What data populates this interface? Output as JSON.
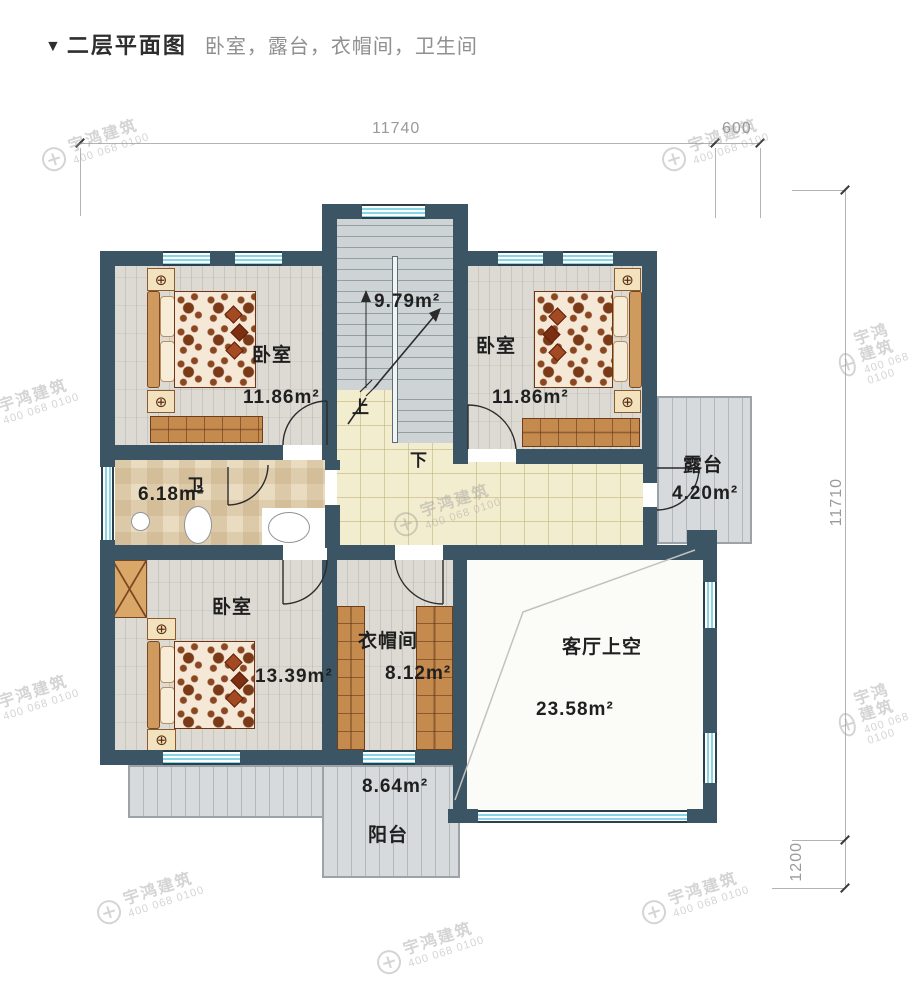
{
  "header": {
    "marker": "▼",
    "title": "二层平面图",
    "subtitle": "卧室，露台，衣帽间，卫生间"
  },
  "dimensions": {
    "top": "11740",
    "top_right": "600",
    "right": "11710",
    "bottom_right": "1200"
  },
  "rooms": {
    "bedroom_top_left": {
      "name": "卧室",
      "area": "11.86m²"
    },
    "bedroom_top_right": {
      "name": "卧室",
      "area": "11.86m²"
    },
    "bedroom_bottom_left": {
      "name": "卧室",
      "area": "13.39m²"
    },
    "stairwell": {
      "area": "9.79m²",
      "up_label": "上",
      "down_label": "下"
    },
    "bathroom": {
      "name": "卫",
      "area": "6.18m²"
    },
    "cloakroom": {
      "name": "衣帽间",
      "area": "8.12m²"
    },
    "terrace": {
      "name": "露台",
      "area": "4.20m²"
    },
    "living_room_void": {
      "name": "客厅上空",
      "area": "23.58m²"
    },
    "balcony": {
      "name": "阳台",
      "area": "8.64m²"
    }
  },
  "watermark": {
    "brand": "宇鸿建筑",
    "phone": "400 068 0100"
  },
  "colors": {
    "wall": "#3b5565",
    "window_glass": "#86d6e6",
    "hallway": "#f3edcf",
    "wood": "#c48a4e"
  }
}
